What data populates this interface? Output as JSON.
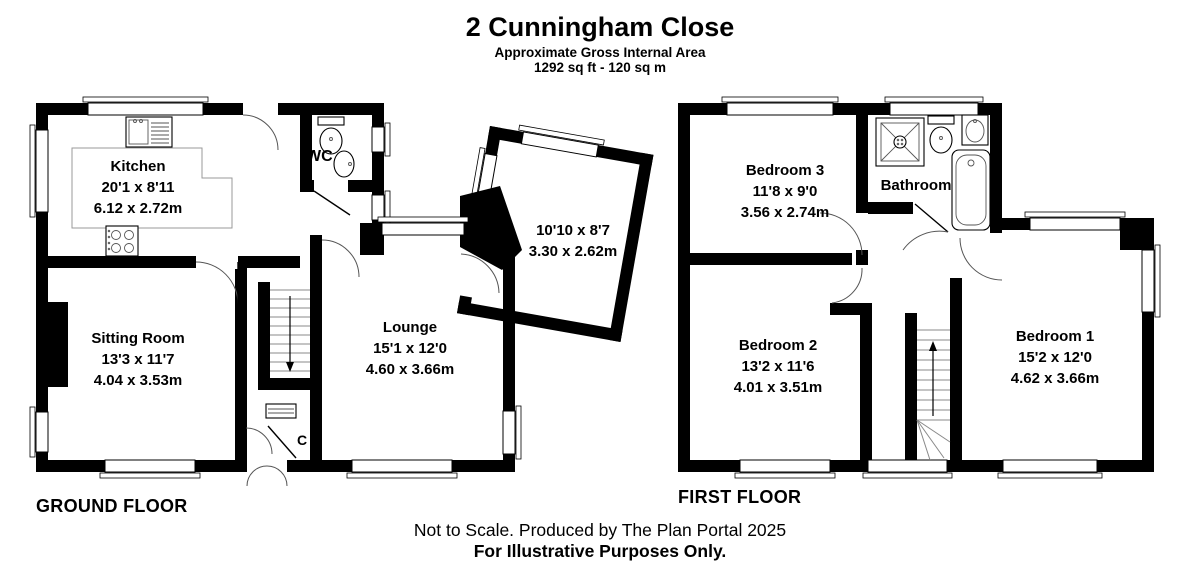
{
  "title": {
    "name": "2 Cunningham Close",
    "subtitle": "Approximate Gross Internal Area",
    "area": "1292 sq ft - 120 sq m"
  },
  "footer": {
    "line1": "Not to Scale. Produced by The Plan Portal 2025",
    "line2": "For Illustrative Purposes Only."
  },
  "colors": {
    "wall": "#000000",
    "background": "#ffffff",
    "line": "#555555"
  },
  "fixtures": {
    "ground": [
      "kitchen-sink",
      "hob",
      "toilet",
      "basin"
    ],
    "first": [
      "shower",
      "toilet",
      "basin",
      "bathtub"
    ]
  },
  "floors": {
    "ground": {
      "label": "GROUND FLOOR",
      "rooms": {
        "kitchen": {
          "name": "Kitchen",
          "imperial": "20'1 x 8'11",
          "metric": "6.12 x 2.72m"
        },
        "sitting_room": {
          "name": "Sitting Room",
          "imperial": "13'3 x 11'7",
          "metric": "4.04 x 3.53m"
        },
        "lounge": {
          "name": "Lounge",
          "imperial": "15'1 x 12'0",
          "metric": "4.60 x 3.66m"
        },
        "conservatory": {
          "imperial": "10'10 x 8'7",
          "metric": "3.30 x 2.62m"
        },
        "wc": {
          "name": "WC"
        },
        "cupboard": {
          "name": "C"
        }
      }
    },
    "first": {
      "label": "FIRST FLOOR",
      "rooms": {
        "bedroom3": {
          "name": "Bedroom 3",
          "imperial": "11'8 x 9'0",
          "metric": "3.56 x 2.74m"
        },
        "bathroom": {
          "name": "Bathroom"
        },
        "bedroom2": {
          "name": "Bedroom 2",
          "imperial": "13'2 x 11'6",
          "metric": "4.01 x 3.51m"
        },
        "bedroom1": {
          "name": "Bedroom 1",
          "imperial": "15'2 x 12'0",
          "metric": "4.62 x 3.66m"
        }
      }
    }
  }
}
